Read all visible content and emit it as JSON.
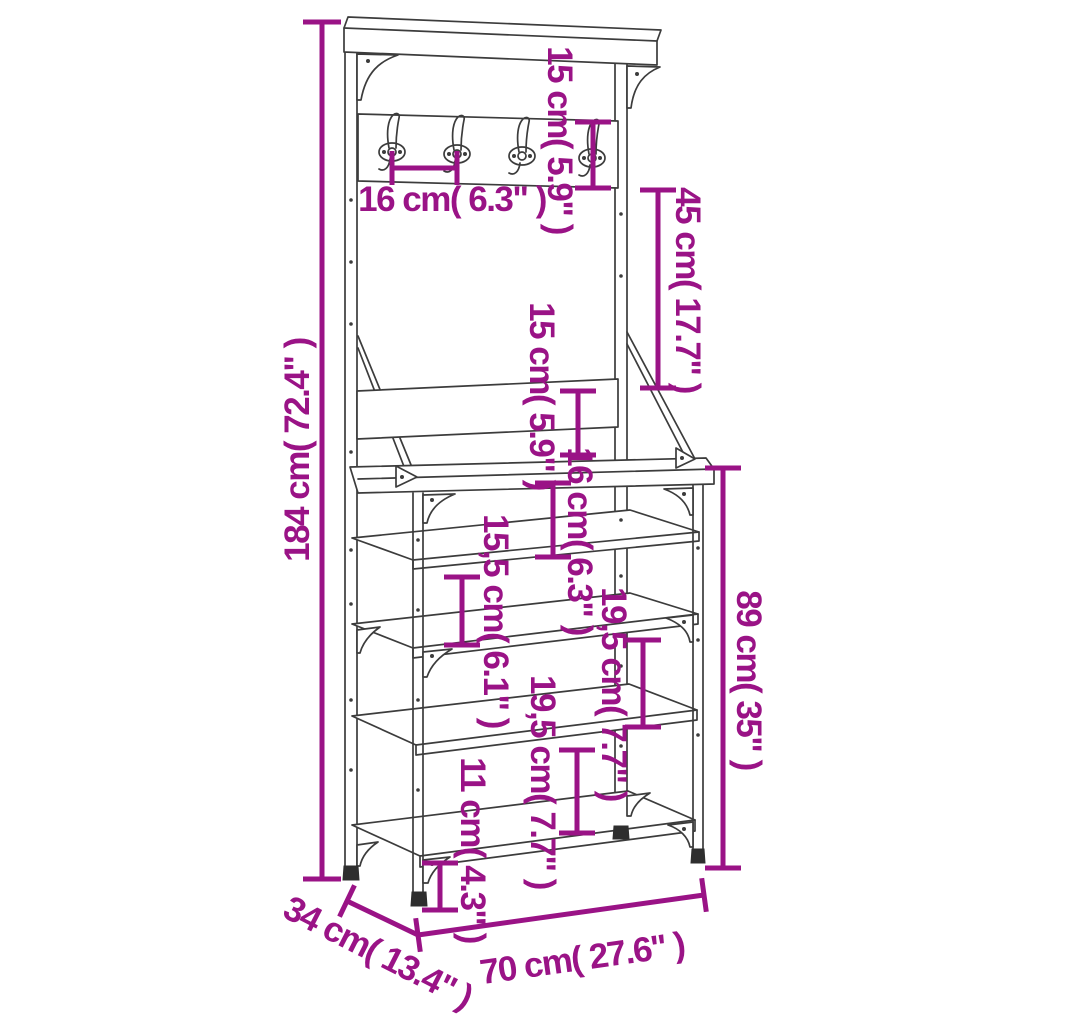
{
  "figure": {
    "kind": "product dimension diagram",
    "background_color": "#ffffff",
    "accent_color": "#9A1386",
    "line_art_color": "#3C3C3C"
  },
  "product": {
    "hook_count": 4,
    "lower_shelf_count": 4,
    "has_top_shelf": true,
    "has_coat_hook_rail": true
  },
  "dims": {
    "total_height": {
      "label": "184 cm( 72.4\" )",
      "cm": 184,
      "inch": 72.4
    },
    "hook_rail_height": {
      "label": "15 cm( 5.9\" )",
      "cm": 15,
      "inch": 5.9
    },
    "hook_spacing": {
      "label": "16 cm( 6.3\" )",
      "cm": 16,
      "inch": 6.3
    },
    "rail_to_backrest": {
      "label": "45 cm( 17.7\" )",
      "cm": 45,
      "inch": 17.7
    },
    "backrest_height": {
      "label": "15 cm( 5.9\" )",
      "cm": 15,
      "inch": 5.9
    },
    "top_shelf_gap": {
      "label": "16 cm( 6.3\" )",
      "cm": 16,
      "inch": 6.3
    },
    "shelf_gap_upper": {
      "label": "15,5 cm( 6.1\" )",
      "cm": 15.5,
      "inch": 6.1
    },
    "shelf_gap_mid": {
      "label": "19,5 cm( 7.7\" )",
      "cm": 19.5,
      "inch": 7.7
    },
    "shelf_gap_lower": {
      "label": "19,5 cm( 7.7\" )",
      "cm": 19.5,
      "inch": 7.7
    },
    "bottom_clearance": {
      "label": "11 cm( 4.3\" )",
      "cm": 11,
      "inch": 4.3
    },
    "bench_height": {
      "label": "89 cm( 35\" )",
      "cm": 89,
      "inch": 35
    },
    "width": {
      "label": "70 cm( 27.6\" )",
      "cm": 70,
      "inch": 27.6
    },
    "depth": {
      "label": "34 cm( 13.4\" )",
      "cm": 34,
      "inch": 13.4
    }
  }
}
